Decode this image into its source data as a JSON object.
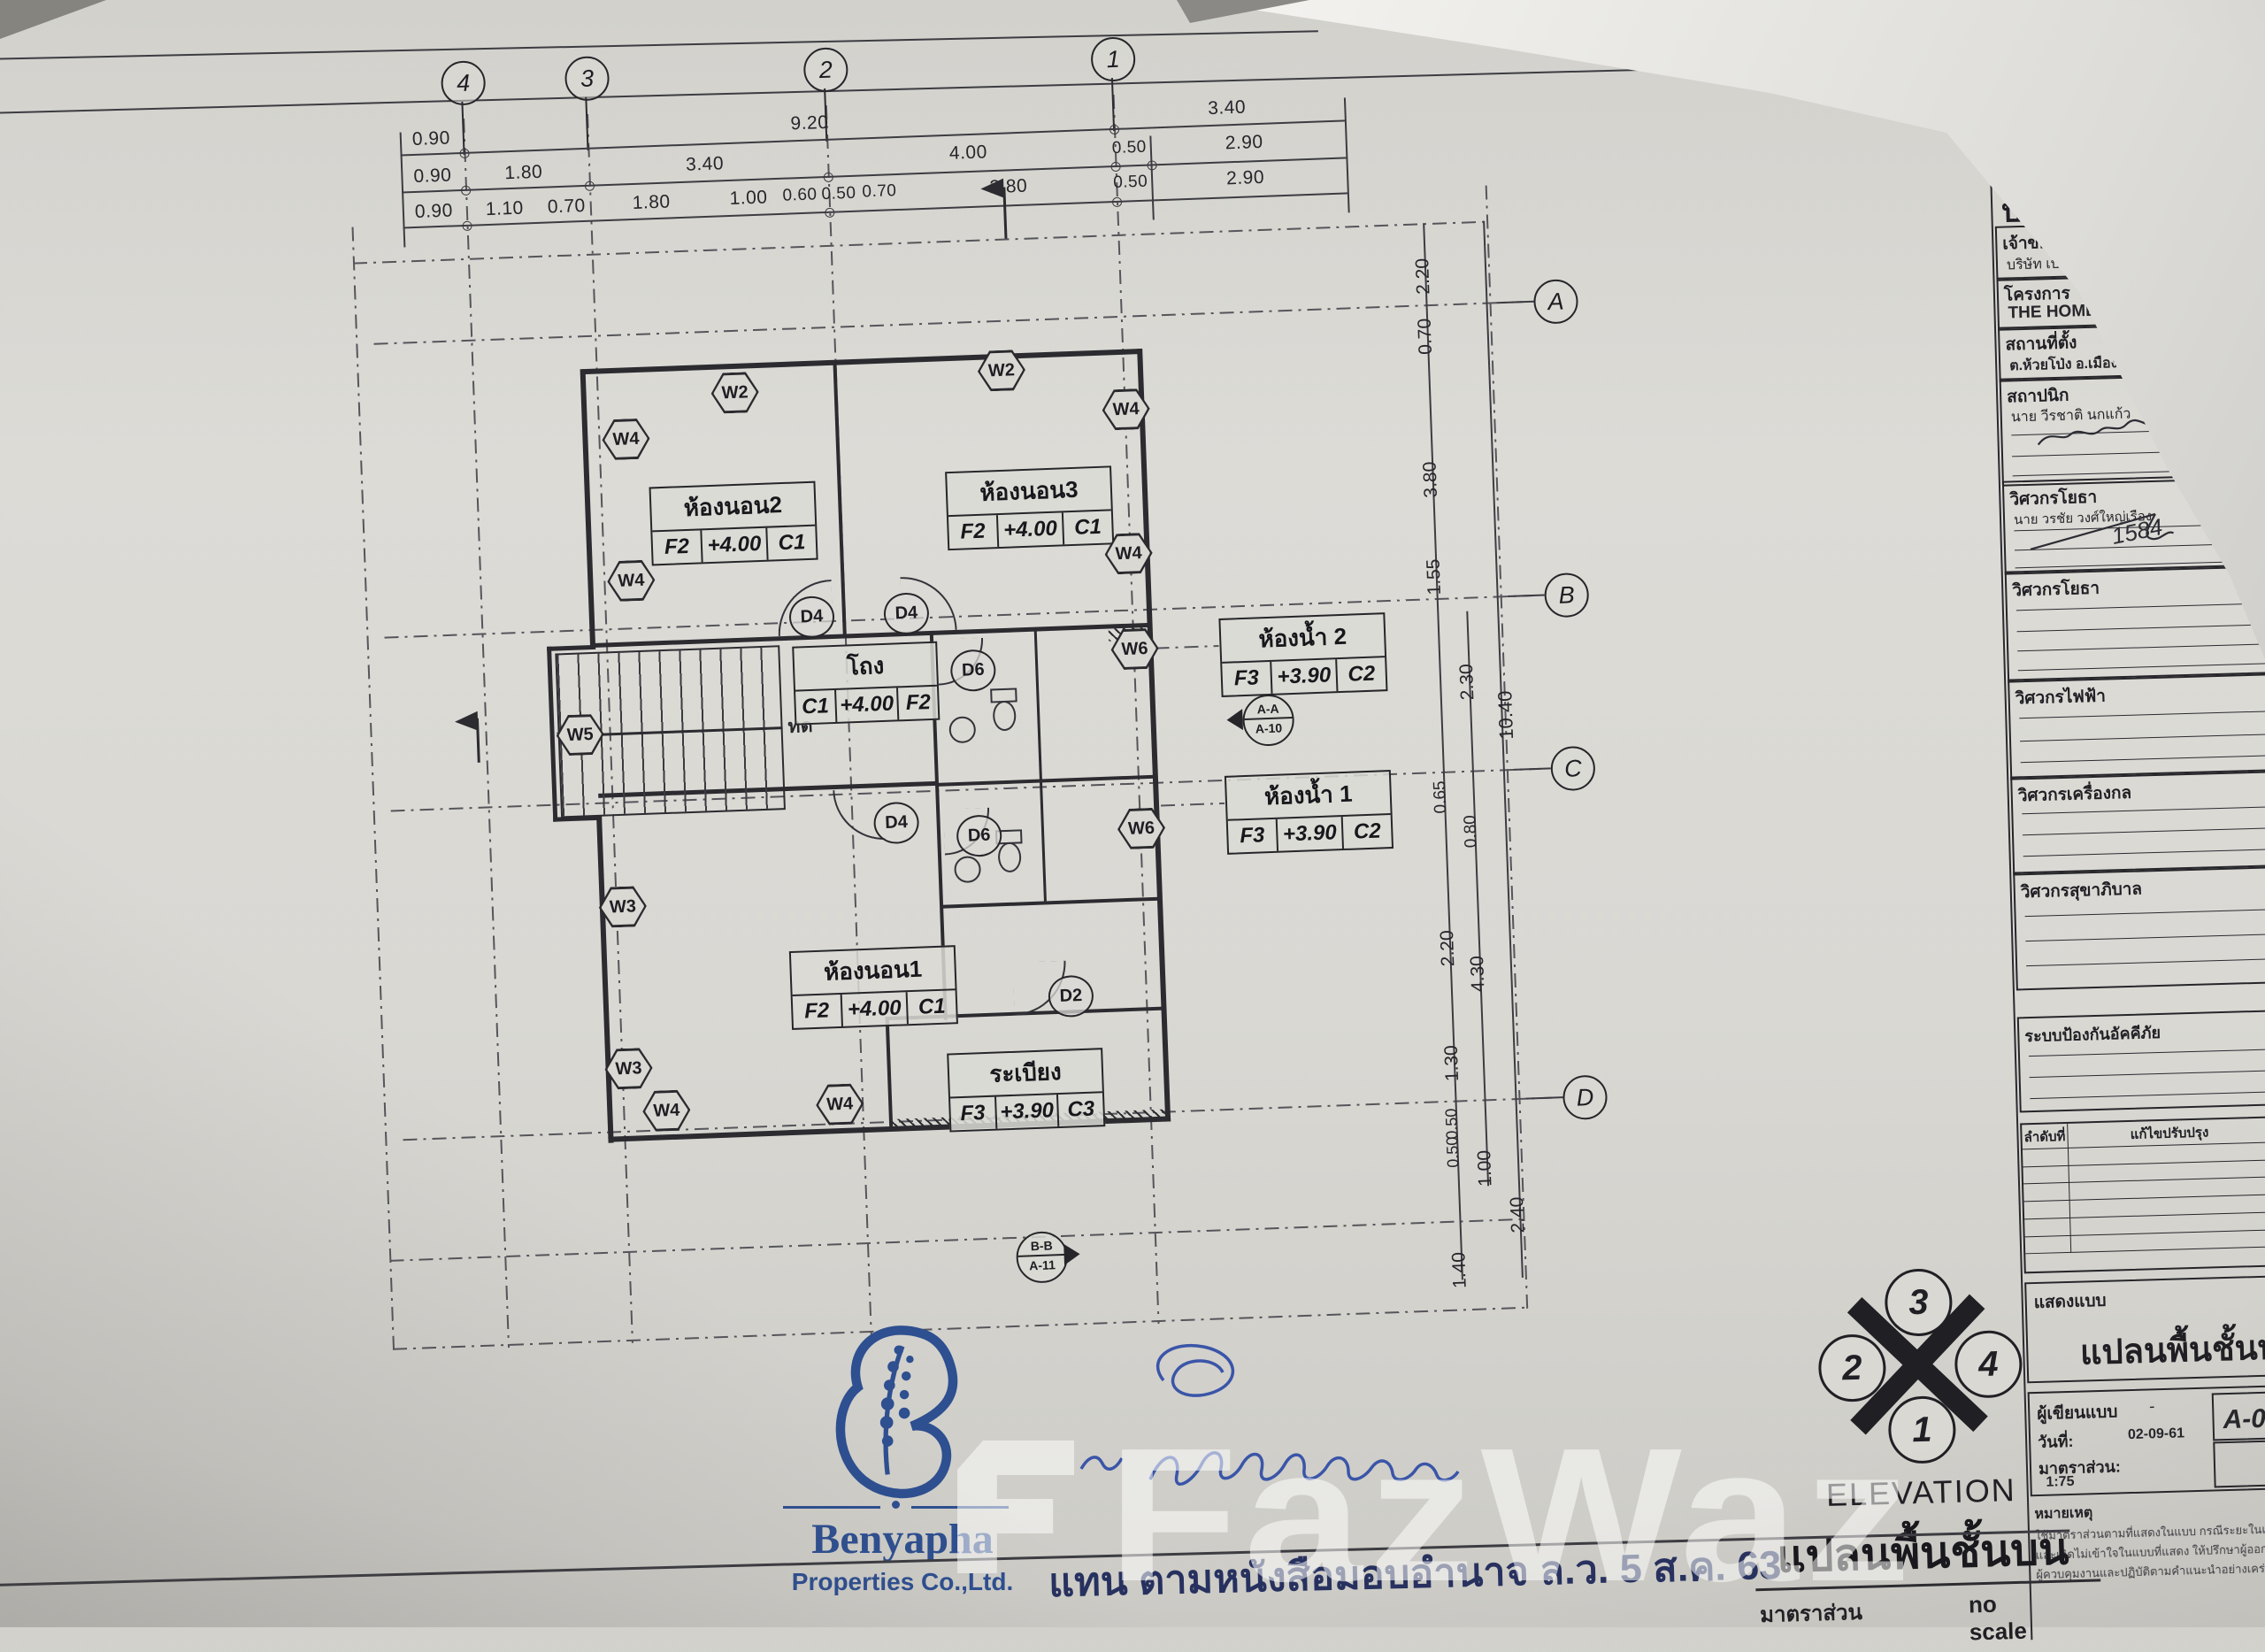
{
  "grid": {
    "cols": [
      "4",
      "3",
      "2",
      "1"
    ],
    "rows": [
      "A",
      "B",
      "C",
      "D"
    ]
  },
  "dims": {
    "top1": [
      "0.90",
      "9.20",
      "3.40"
    ],
    "top2": [
      "0.90",
      "1.80",
      "3.40",
      "4.00",
      "0.50",
      "2.90"
    ],
    "top3": [
      "0.90",
      "1.10",
      "0.70",
      "1.80",
      "1.00",
      "0.60",
      "0.50",
      "0.70",
      "2.80",
      "0.50",
      "2.90"
    ],
    "right": [
      "2.20",
      "0.70",
      "3.80",
      "1.55",
      "2.30",
      "10.40",
      "0.65",
      "0.80",
      "2.20",
      "4.30",
      "1.30",
      "0.50",
      "0.50",
      "1.00",
      "2.40",
      "1.40"
    ]
  },
  "rooms": [
    {
      "name": "ห้องนอน2",
      "a": "F2",
      "b": "+4.00",
      "c": "C1"
    },
    {
      "name": "ห้องนอน3",
      "a": "F2",
      "b": "+4.00",
      "c": "C1"
    },
    {
      "name": "โถง",
      "a": "C1",
      "b": "+4.00",
      "c": "F2"
    },
    {
      "name": "ห้องน้ำ 2",
      "a": "F3",
      "b": "+3.90",
      "c": "C2"
    },
    {
      "name": "ห้องน้ำ 1",
      "a": "F3",
      "b": "+3.90",
      "c": "C2"
    },
    {
      "name": "ห้องนอน1",
      "a": "F2",
      "b": "+4.00",
      "c": "C1"
    },
    {
      "name": "ระเบียง",
      "a": "F3",
      "b": "+3.90",
      "c": "C3"
    }
  ],
  "tags": {
    "w2": "W2",
    "w3": "W3",
    "w4": "W4",
    "w5": "W5",
    "w6": "W6",
    "d2": "D2",
    "d4": "D4",
    "d6": "D6"
  },
  "sections": {
    "aa1": "A-A",
    "aa2": "A-10",
    "bb1": "B-B",
    "bb2": "A-11"
  },
  "stair_note": "ทด",
  "compass": {
    "n3": "3",
    "n2": "2",
    "n4": "4",
    "n1": "1",
    "label": "ELEVATION",
    "title": "แปลนพื้นชั้นบน",
    "scale_label": "มาตราส่วน",
    "scale_value": "no scale"
  },
  "logo": {
    "brand": "Benyapha",
    "subtitle": "Properties Co.,Ltd."
  },
  "stamp": "แทน ตามหนังสือมอบอำนาจ ล.ว. 5 ส.ค. 63",
  "watermark": "FazWaz",
  "titleblock": {
    "tab": "แบบ",
    "doc1": "แบบ",
    "doc2": "บ้านพัก",
    "owner_label": "เจ้าของ",
    "owner": "บริษัท เบญจภา พร็อพเพอร์ตี้ส์ จำกัด",
    "project_label": "โครงการ",
    "project": "THE HOME",
    "site_label": "สถานที่ตั้ง",
    "site": "ต.ห้วยโป่ง อ.เมือง จ.ระยอง",
    "architect_label": "สถาปนิก",
    "architect_name": "นาย วีรชาติ นกแก้ว",
    "architect_lic": "ภ-สถ. 21183",
    "civil_label": "วิศวกรโยธา",
    "civil_name": "นาย วรชัย วงศ์ใหญ่เรือง",
    "civil_lic": "กย 19365",
    "civil_sig": "1584",
    "civil2_label": "วิศวกรโยธา",
    "elec_label": "วิศวกรไฟฟ้า",
    "mech_label": "วิศวกรเครื่องกล",
    "sani_label": "วิศวกรสุขาภิบาล",
    "fire_label": "ระบบป้องกันอัคคีภัย",
    "rev_no": "ลำดับที่",
    "rev_fix": "แก้ไขปรับปรุง",
    "rev_date": "วันที่",
    "show_label": "แสดงแบบ",
    "show_title": "แปลนพื้นชั้นบน",
    "drafter_label": "ผู้เขียนแบบ",
    "drafter": "-",
    "date_label": "วันที่:",
    "date": "02-09-61",
    "scale_label": "มาตราส่วน:",
    "scale": "1:75",
    "sheet_label": "แผ่นที่",
    "sheet": "A-0",
    "sum_label": "รวม",
    "note_label": "หมายเหตุ",
    "note1": "ใช้มาตราส่วนตามที่แสดงในแบบ กรณีระยะในแบบไม่ชัดเจน",
    "note2": "และเกิดไม่เข้าใจในแบบที่แสดง ให้ปรึกษาผู้ออกแบบ",
    "note3": "ผู้ควบคุมงานและปฏิบัติตามคำแนะนำอย่างเคร่งครัด"
  }
}
